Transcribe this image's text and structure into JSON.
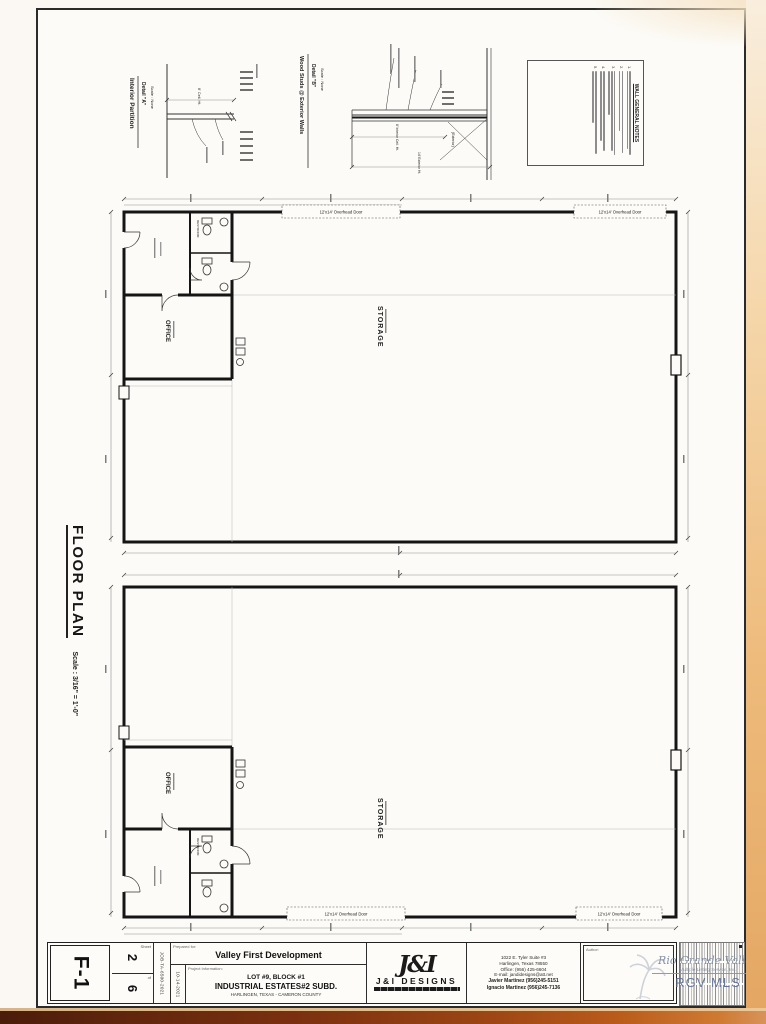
{
  "sheet": {
    "id": "F-1",
    "sheet_number": "2",
    "sheet_total": "6",
    "sheet_label": "Sheet",
    "of_label": "of",
    "job_number": "JOB-TA-6500-2021",
    "date": "10-14-2021",
    "prepared_for_label": "Prepared for:",
    "project_info_label": "Project Information:",
    "author_label": "Author:"
  },
  "title_block": {
    "client": "Valley First Development",
    "project_line1": "LOT #9, BLOCK #1",
    "project_line2": "INDUSTRIAL ESTATES#2 SUBD.",
    "project_line3": "HARLINGEN, TEXAS - CAMERON COUNTY",
    "firm_monogram": "J&I",
    "firm_name": "J&I DESIGNS",
    "firm_address1": "1022 E. Tyler Suite #3",
    "firm_address2": "Harlingen, Texas 78550",
    "firm_phone": "Office:  (956) 425-6604",
    "firm_email": "E-mail:  jandidesigns@att.net",
    "firm_contact1": "Javier Martinez  (956)245-5151",
    "firm_contact2": "Ignacio Martinez  (956)245-7136"
  },
  "watermark": {
    "line1": "Rio Grande Valley",
    "line2": "Multiple Listing Service, Inc.",
    "line3": "RGV MLS"
  },
  "floor_plan": {
    "title": "FLOOR PLAN",
    "scale": "Scale : 3/16\" = 1'-0\""
  },
  "details": {
    "a_title": "Interior Partition",
    "a_name": "Detail \"A\"",
    "a_scale": "Scale : None",
    "a_dim": "8' Ceil. Ht.",
    "b_title": "Wood Studs @ Exterior Walls",
    "b_name": "Detail \"B\"",
    "b_scale": "Scale : None",
    "b_dim1": "8' Interior Ceil. Ht.",
    "b_dim2": "14' Exterior Ht.",
    "b_side": "(Exterior)"
  },
  "wall_notes": {
    "title": "WALL GENERAL NOTES",
    "numbers": [
      "1.",
      "2.",
      "3.",
      "4.",
      "5."
    ]
  },
  "rooms": {
    "storage": "STORAGE",
    "office": "OFFICE",
    "restroom": "RESTROOM",
    "overhead_door": "12'x14' Overhead Door"
  }
}
